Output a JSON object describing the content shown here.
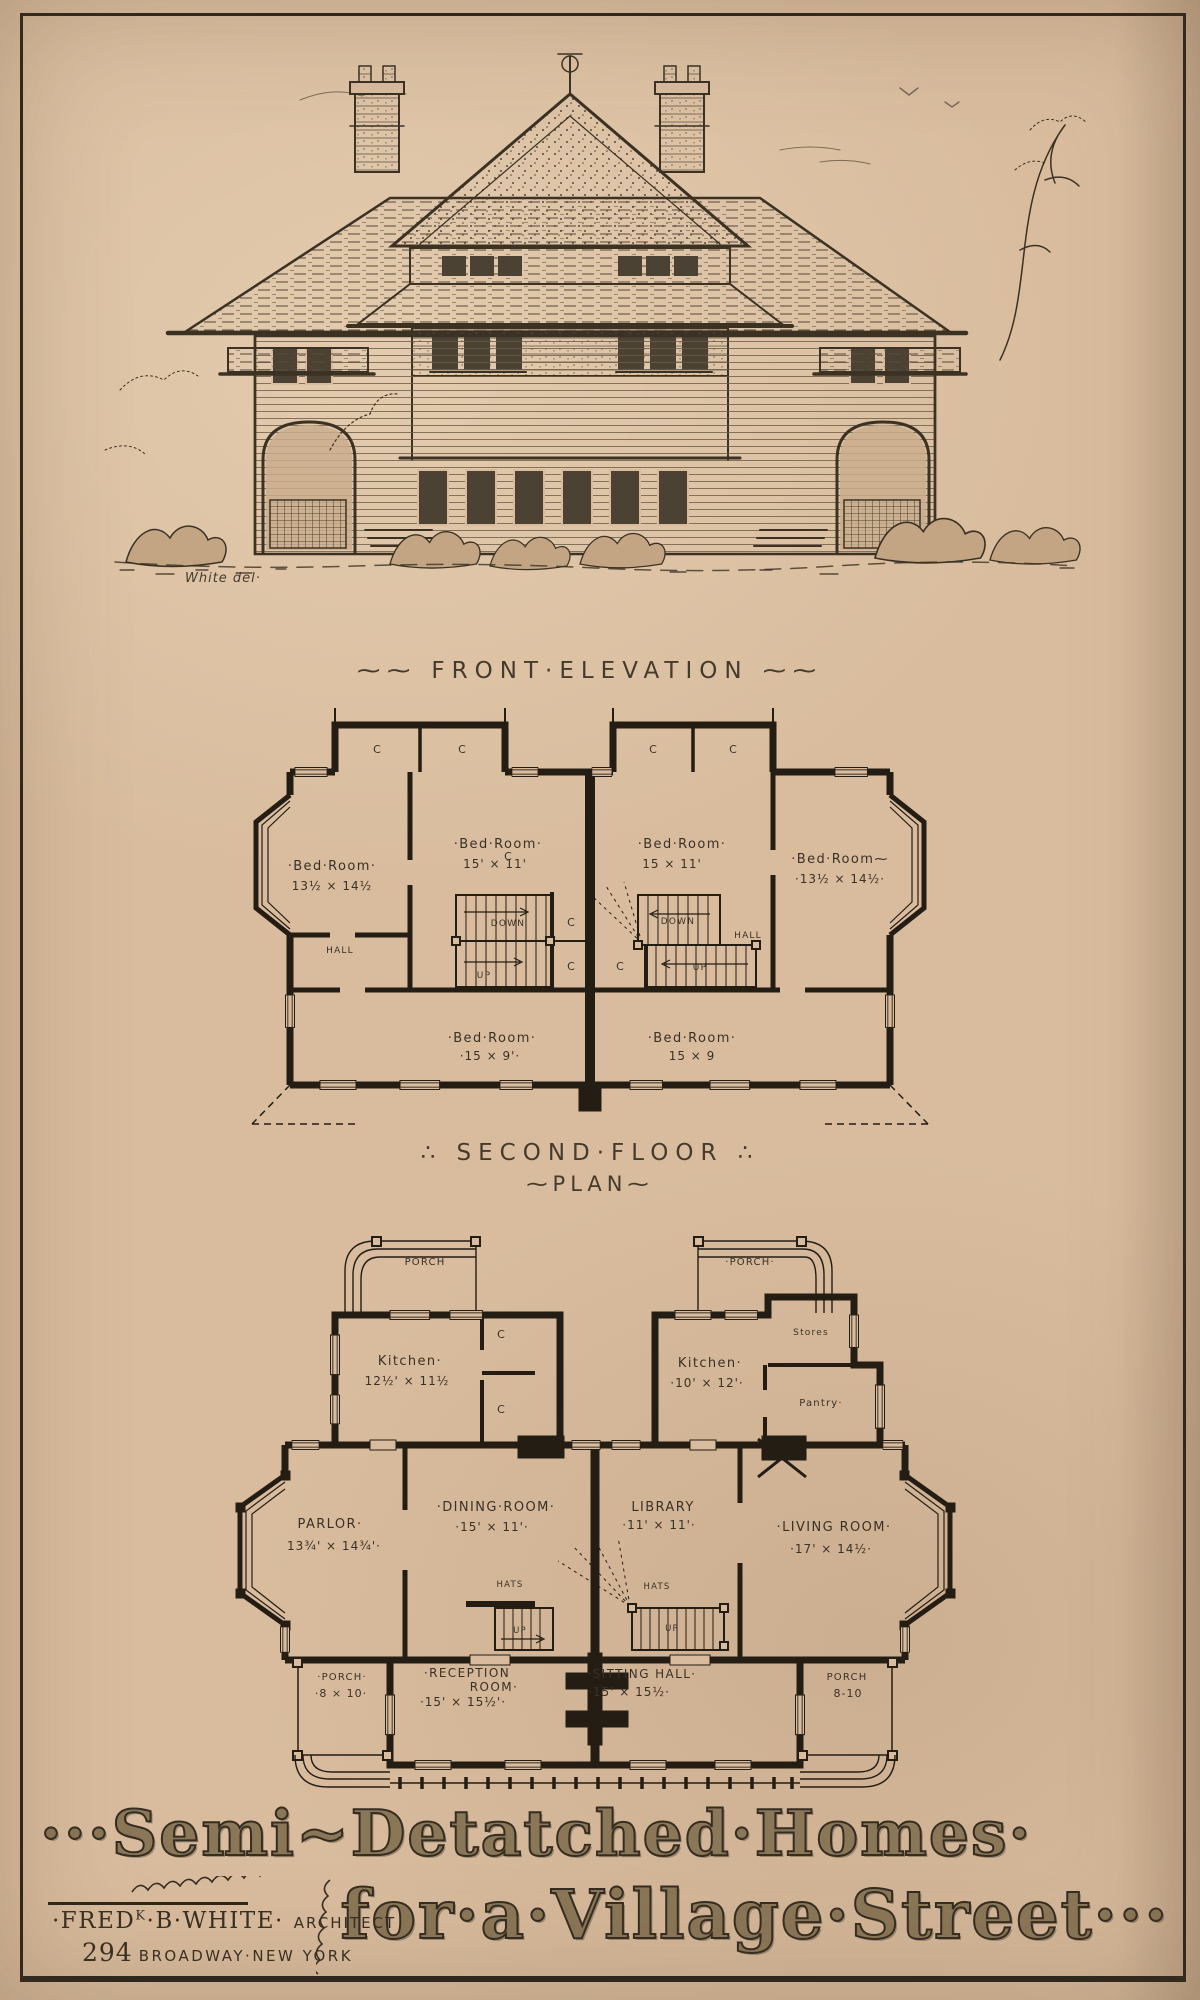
{
  "page": {
    "paper_color": "#d9bc9e",
    "ink_color": "#342c20",
    "wall_color": "#241d14"
  },
  "elevation": {
    "caption": "⁓⁓ FRONT·ELEVATION ⁓⁓",
    "signature": "White del·"
  },
  "second_floor": {
    "caption_line1": "∴ SECOND·FLOOR ∴",
    "caption_line2": "⁓PLAN⁓",
    "rooms": {
      "bed_left": {
        "name": "·Bed·Room·",
        "dims": "13½ × 14½"
      },
      "bed_mid_left": {
        "name": "·Bed·Room·",
        "dims": "15' × 11'"
      },
      "bed_mid_right": {
        "name": "·Bed·Room·",
        "dims": "15 × 11'"
      },
      "bed_right": {
        "name": "·Bed·Room⁓",
        "dims": "·13½ × 14½·"
      },
      "bed_back_left": {
        "name": "·Bed·Room·",
        "dims": "·15 × 9'·"
      },
      "bed_back_right": {
        "name": "·Bed·Room·",
        "dims": "15 × 9"
      },
      "hall": "HALL",
      "down": "DOWN",
      "up": "UP",
      "closet": "C"
    }
  },
  "first_floor": {
    "rooms": {
      "porch_top_left": "PORCH",
      "porch_top_right": "·PORCH·",
      "kitchen_left": {
        "name": "Kitchen·",
        "dims": "12½' × 11½"
      },
      "kitchen_right": {
        "name": "Kitchen·",
        "dims": "·10' × 12'·"
      },
      "stores": "Stores",
      "pantry": "Pantry·",
      "parlor": {
        "name": "PARLOR·",
        "dims": "13¾' × 14¾'·"
      },
      "dining": {
        "name": "·DINING·ROOM·",
        "dims": "·15' × 11'·"
      },
      "library": {
        "name": "LIBRARY",
        "dims": "·11' × 11'·"
      },
      "living": {
        "name": "·LIVING ROOM·",
        "dims": "·17' × 14½·"
      },
      "hats": "HATS",
      "up": "UP",
      "closet": "C",
      "porch_bottom_left": {
        "name": "·PORCH·",
        "dims": "·8 × 10·"
      },
      "reception": {
        "name": "·RECEPTION",
        "name2": "ROOM·",
        "dims": "·15' × 15½'·"
      },
      "sitting": {
        "name": "·SITTING HALL·",
        "dims": "·15' × 15½·"
      },
      "porch_bottom_right": {
        "name": "PORCH",
        "dims": "8-10"
      }
    }
  },
  "title": {
    "line1": "···Semi~Detatched·Homes·",
    "line2": "for·a·Village·Street···",
    "architect_name_pre": "·FRED",
    "architect_name_sup": "K",
    "architect_name_post": "·B·WHITE·",
    "architect_role": "ARCHITECT",
    "address_number": "294",
    "address_rest": "BROADWAY·NEW YORK"
  }
}
